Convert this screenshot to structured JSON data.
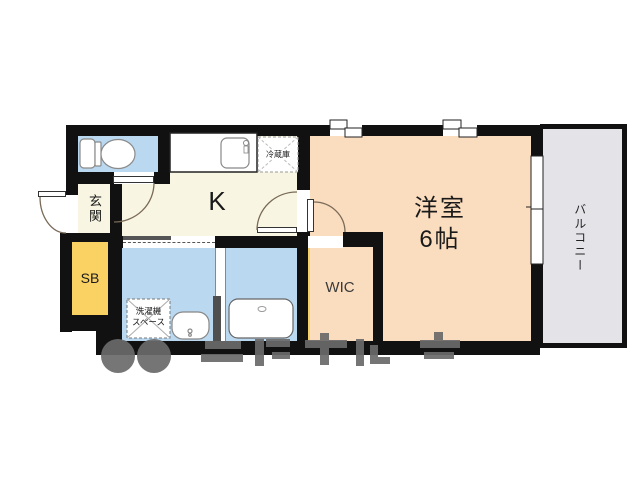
{
  "floorplan": {
    "rooms": {
      "kitchen": {
        "label": "K"
      },
      "western_room": {
        "label": "洋室",
        "size": "6帖"
      },
      "entrance": {
        "label": "玄関"
      },
      "shoe_box": {
        "label": "SB"
      },
      "walk_in_closet": {
        "label": "WIC"
      },
      "balcony": {
        "label": "バルコニー"
      },
      "refrigerator_space": {
        "label": "冷蔵庫"
      },
      "washer_space": {
        "label_line1": "洗濯機",
        "label_line2": "スペース"
      }
    },
    "colors": {
      "wall": "#111111",
      "kitchen_hall_floor": "#f8f6e2",
      "wet_area_floor": "#bad9f1",
      "storage_floor": "#fad264",
      "western_room_floor": "#fadcbe",
      "balcony_floor": "#e4e3e8",
      "door_arc": "#7a6a58",
      "watermark": "#6a6a6a"
    }
  }
}
